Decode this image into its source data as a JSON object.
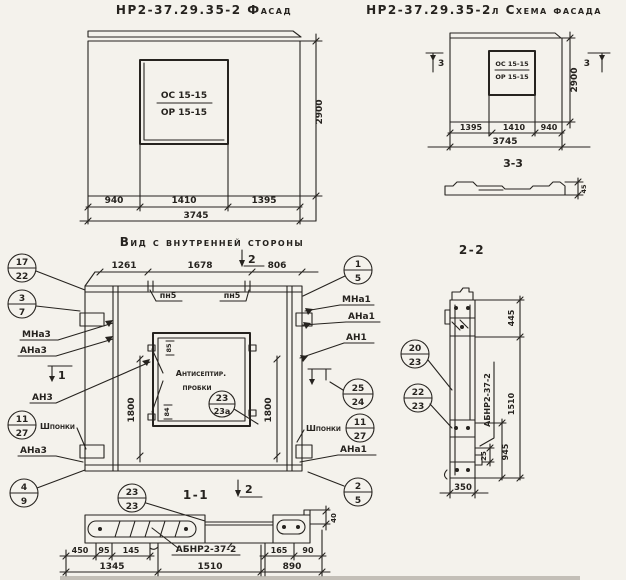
{
  "colors": {
    "paper": "#f4f2ec",
    "ink": "#26231f"
  },
  "facade_left": {
    "title": "НР2-37.29.35-2 Фасад",
    "window_top": "ОС 15-15",
    "window_bottom": "ОР 15-15",
    "dim_940": "940",
    "dim_1410": "1410",
    "dim_1395": "1395",
    "dim_total": "3745",
    "dim_height": "2900"
  },
  "facade_right": {
    "title": "НР2-37.29.35-2л Схема фасада",
    "window_top": "ОС 15-15",
    "window_bottom": "ОР 15-15",
    "dim_1395": "1395",
    "dim_1410": "1410",
    "dim_940": "940",
    "dim_total": "3745",
    "dim_height": "2900",
    "marker": "3",
    "section_title": "3-3",
    "profile_dim": "45"
  },
  "inner": {
    "title": "Вид с внутренней стороны",
    "dim_1261": "1261",
    "dim_1678": "1678",
    "dim_806": "806",
    "dim_1800": "1800",
    "pn5": "пн5",
    "marker_1": "1",
    "marker_2": "2",
    "note1": "Антисептир.",
    "note2": "пробки",
    "dim_85": "85",
    "dim_84": "84",
    "shponki": "Шпонки",
    "lbl_mna3": "МНа3",
    "lbl_ana3_top": "АНа3",
    "lbl_an3": "АН3",
    "lbl_ana3_bot": "АНа3",
    "lbl_mna1": "МНа1",
    "lbl_ana1_top": "АНа1",
    "lbl_an1": "АН1",
    "lbl_ana1_bot": "АНа1",
    "c17_22": {
      "t": "17",
      "b": "22"
    },
    "c3_7": {
      "t": "3",
      "b": "7"
    },
    "c11_27_l": {
      "t": "11",
      "b": "27"
    },
    "c4_9": {
      "t": "4",
      "b": "9"
    },
    "c1_5": {
      "t": "1",
      "b": "5"
    },
    "c25_24": {
      "t": "25",
      "b": "24"
    },
    "c11_27_r": {
      "t": "11",
      "b": "27"
    },
    "c2_5": {
      "t": "2",
      "b": "5"
    },
    "c23_23a": {
      "t": "23",
      "b": "23а"
    }
  },
  "sec11": {
    "title": "1-1",
    "c23_23": {
      "t": "23",
      "b": "23"
    },
    "label": "АБНР2-37-2",
    "dim_450": "450",
    "dim_95": "95",
    "dim_145": "145",
    "dim_165": "165",
    "dim_90": "90",
    "dim_40": "40",
    "dim_1345": "1345",
    "dim_1510": "1510",
    "dim_890": "890"
  },
  "sec22": {
    "title": "2-2",
    "c20_23": {
      "t": "20",
      "b": "23"
    },
    "c22_23": {
      "t": "22",
      "b": "23"
    },
    "label": "АБНР2-37-2",
    "dim_445": "445",
    "dim_1510": "1510",
    "dim_945": "945",
    "dim_25": "25",
    "dim_350": "350"
  }
}
